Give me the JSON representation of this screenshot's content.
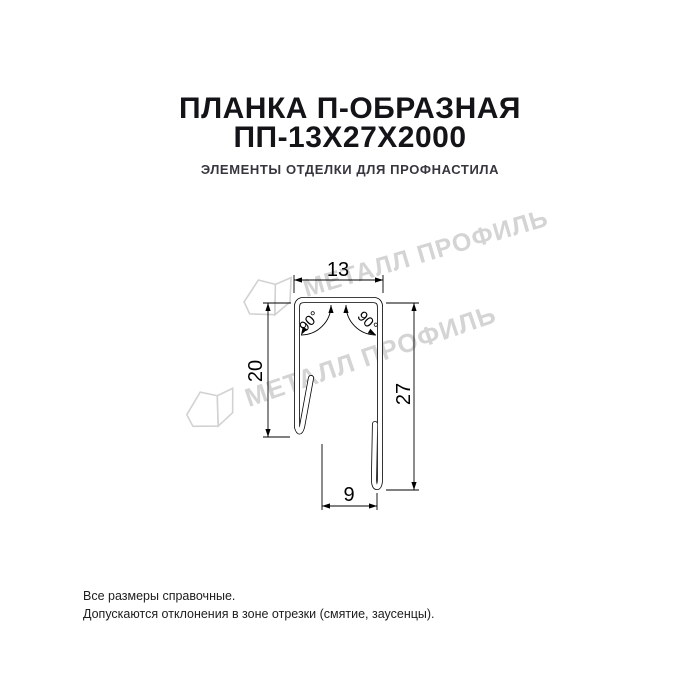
{
  "header": {
    "title_line1": "ПЛАНКА П-ОБРАЗНАЯ",
    "title_line2": "ПП-13Х27Х2000",
    "subtitle": "ЭЛЕМЕНТЫ ОТДЕЛКИ ДЛЯ ПРОФНАСТИЛА"
  },
  "diagram": {
    "dimensions": {
      "top_width": "13",
      "left_height": "20",
      "right_height": "27",
      "bottom_gap": "9"
    },
    "angles": {
      "left": "90°",
      "right": "90°"
    },
    "watermark": {
      "text": "МЕТАЛЛ ПРОФИЛЬ",
      "color": "#d4d4d4"
    }
  },
  "footer": {
    "line1": "Все размеры справочные.",
    "line2": "Допускаются отклонения в зоне отрезки (смятие, заусенцы)."
  },
  "colors": {
    "title": "#141418",
    "subtitle": "#36363e",
    "line": "#000000",
    "watermark": "#d4d4d4",
    "background": "#ffffff"
  }
}
